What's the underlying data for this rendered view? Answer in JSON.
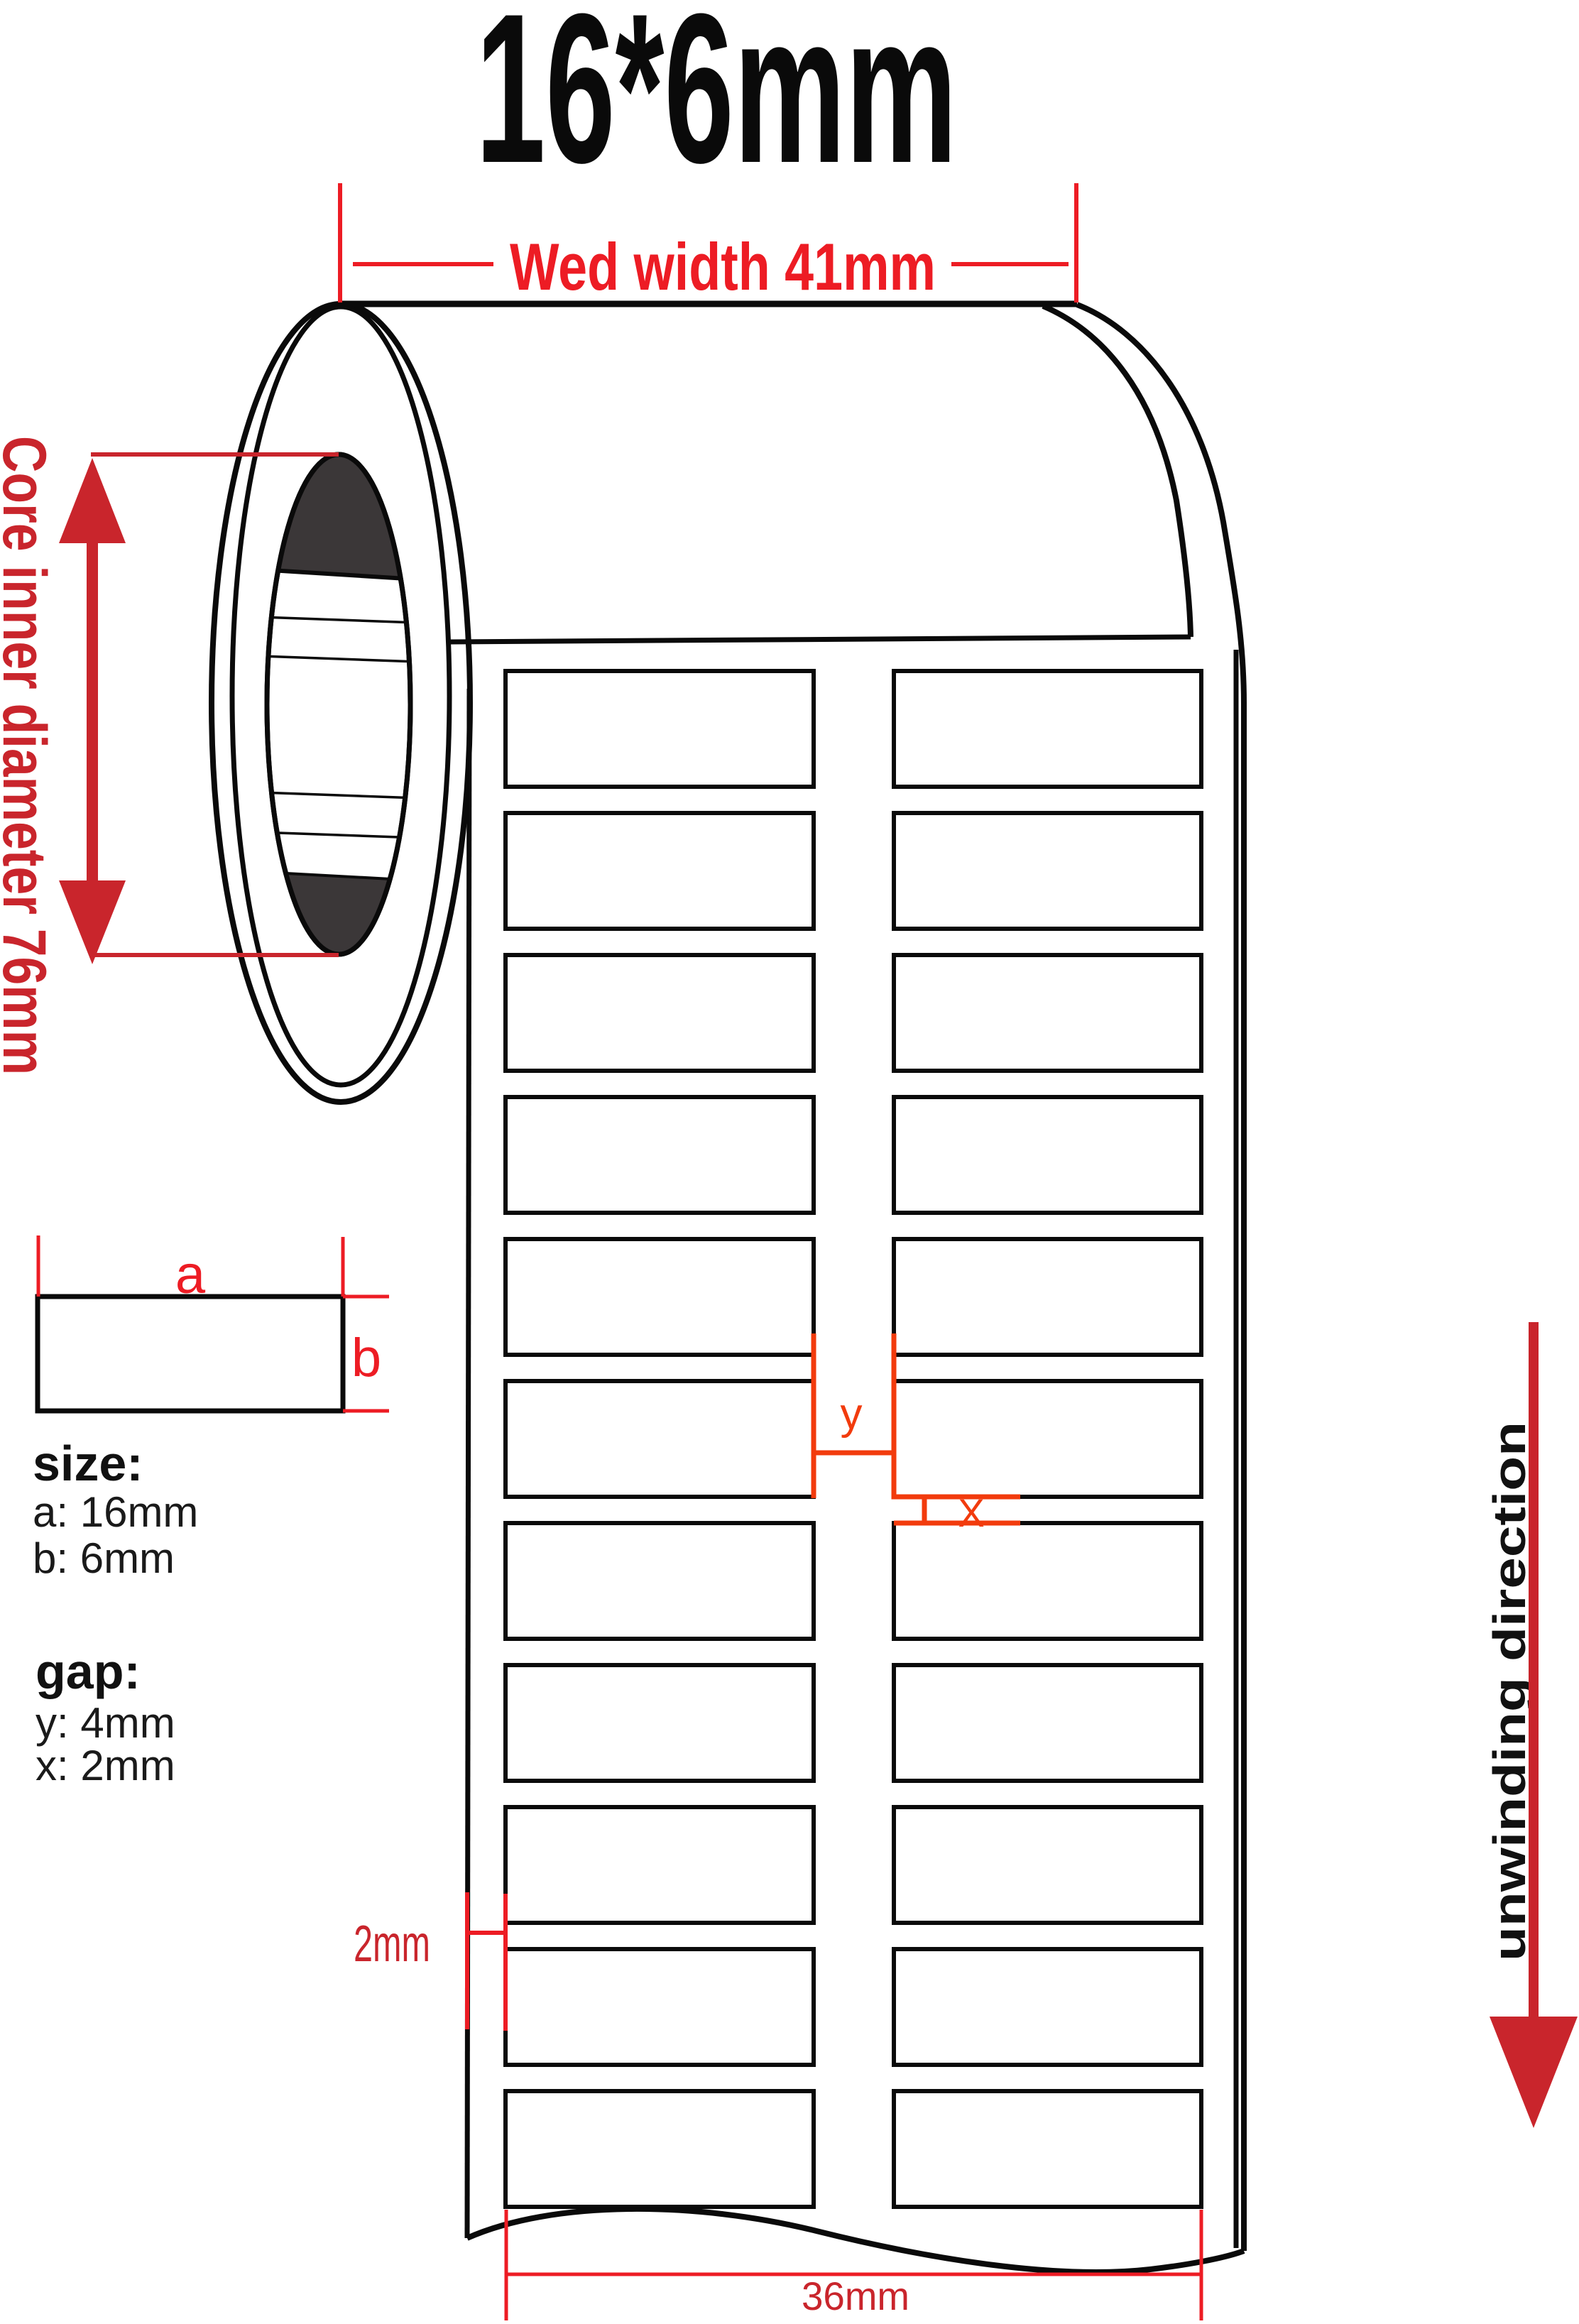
{
  "title": "16*6mm",
  "colors": {
    "red": "#ed1c24",
    "crimson": "#c9252c",
    "orange": "#f23b0d",
    "line_black": "#0a0a0a",
    "core_dark": "#3b3738"
  },
  "dimensions": {
    "web_width_label": "Wed width 41mm",
    "core_label": "Core inner diameter 76mm",
    "edge_margin_label": "2mm",
    "bottom_width_label": "36mm",
    "marker_y": "y",
    "marker_x": "X"
  },
  "legend": {
    "sample_a": "a",
    "sample_b": "b",
    "size_heading": "size:",
    "size_a": "a: 16mm",
    "size_b": "b: 6mm",
    "gap_heading": "gap:",
    "gap_y": "y: 4mm",
    "gap_x": "x: 2mm"
  },
  "unwinding": {
    "label": "unwinding direction"
  },
  "roll": {
    "columns": 2,
    "rows": 11
  }
}
